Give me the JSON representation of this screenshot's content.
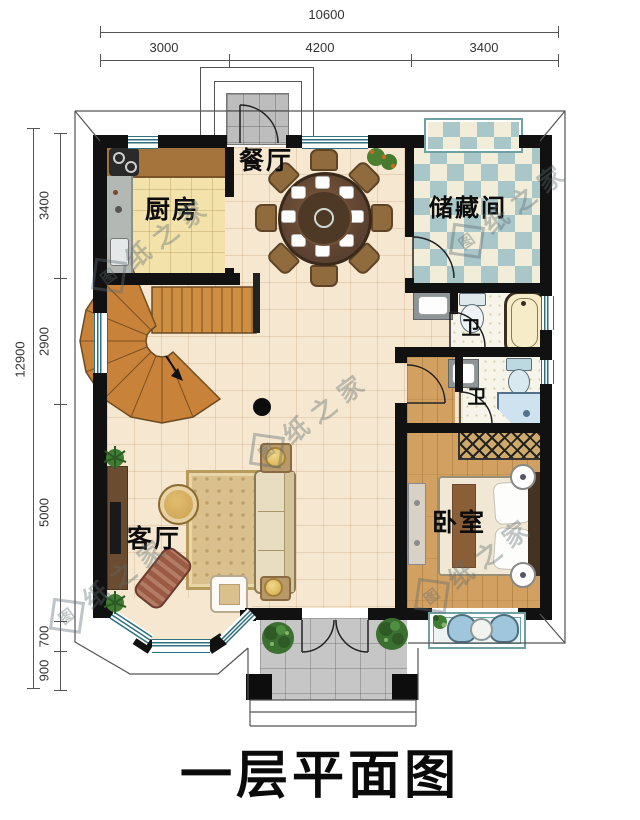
{
  "title": "一层平面图",
  "watermark": {
    "logo_char": "图",
    "text_rest": "纸之家",
    "full_text": "图纸之家"
  },
  "dimensions": {
    "top": {
      "total": "10600",
      "segments": [
        "3000",
        "4200",
        "3400"
      ]
    },
    "left": {
      "total": "12900",
      "segments": [
        "3400",
        "2900",
        "5000",
        "700",
        "900"
      ]
    }
  },
  "rooms": {
    "dining": {
      "label": "餐厅"
    },
    "kitchen": {
      "label": "厨房"
    },
    "storage": {
      "label": "储藏间"
    },
    "bath_upper": {
      "label": "卫"
    },
    "bath_lower": {
      "label": "卫"
    },
    "living": {
      "label": "客厅"
    },
    "bedroom": {
      "label": "卧室"
    }
  },
  "colors": {
    "wall": "#111111",
    "hall_floor": "#f6e8d0",
    "kitchen_floor": "#f3e3ab",
    "wood_floor": "#d2a162",
    "storage_teal": "#a9c6c8",
    "window_teal": "#2e6f80",
    "porch_gray": "#c6c6c6"
  }
}
